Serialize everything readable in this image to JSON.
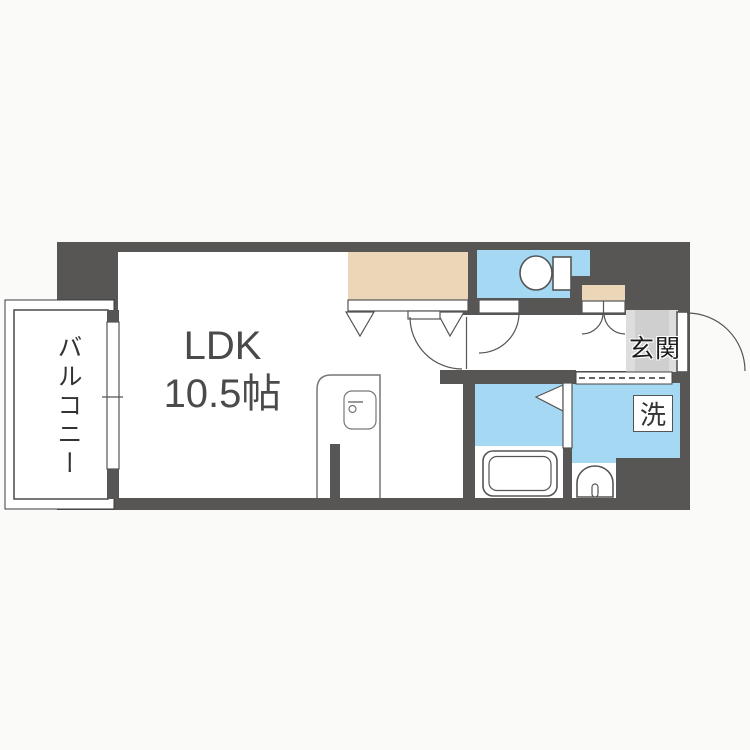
{
  "title": "1K/LDK apartment floor plan",
  "labels": {
    "balcony": "バルコニー",
    "ldk_name": "LDK",
    "ldk_size": "10.5帖",
    "entrance": "玄関",
    "washer": "洗"
  },
  "colors": {
    "wall": "#585555",
    "water_room": "#a5d8f2",
    "closet": "#ebd7b7",
    "entrance_floor": "#d0cfcf",
    "entrance_floor_edge": "#dedddd",
    "background": "#fafaf9",
    "floor": "#ffffff",
    "line": "#555555"
  },
  "rooms": [
    {
      "name": "living-dining-kitchen",
      "label": "LDK 10.5帖"
    },
    {
      "name": "balcony",
      "label": "バルコニー"
    },
    {
      "name": "entrance",
      "label": "玄関"
    },
    {
      "name": "toilet",
      "label": ""
    },
    {
      "name": "bathroom",
      "label": ""
    },
    {
      "name": "washroom",
      "label": "洗"
    }
  ],
  "fixtures": [
    "toilet-icon",
    "bathtub-icon",
    "washbasin-icon",
    "kitchen-unit-icon",
    "closet-bifold-door-icon",
    "swing-door-icon",
    "double-door-icon",
    "entrance-door-icon",
    "window-icon",
    "washing-machine-slot"
  ]
}
